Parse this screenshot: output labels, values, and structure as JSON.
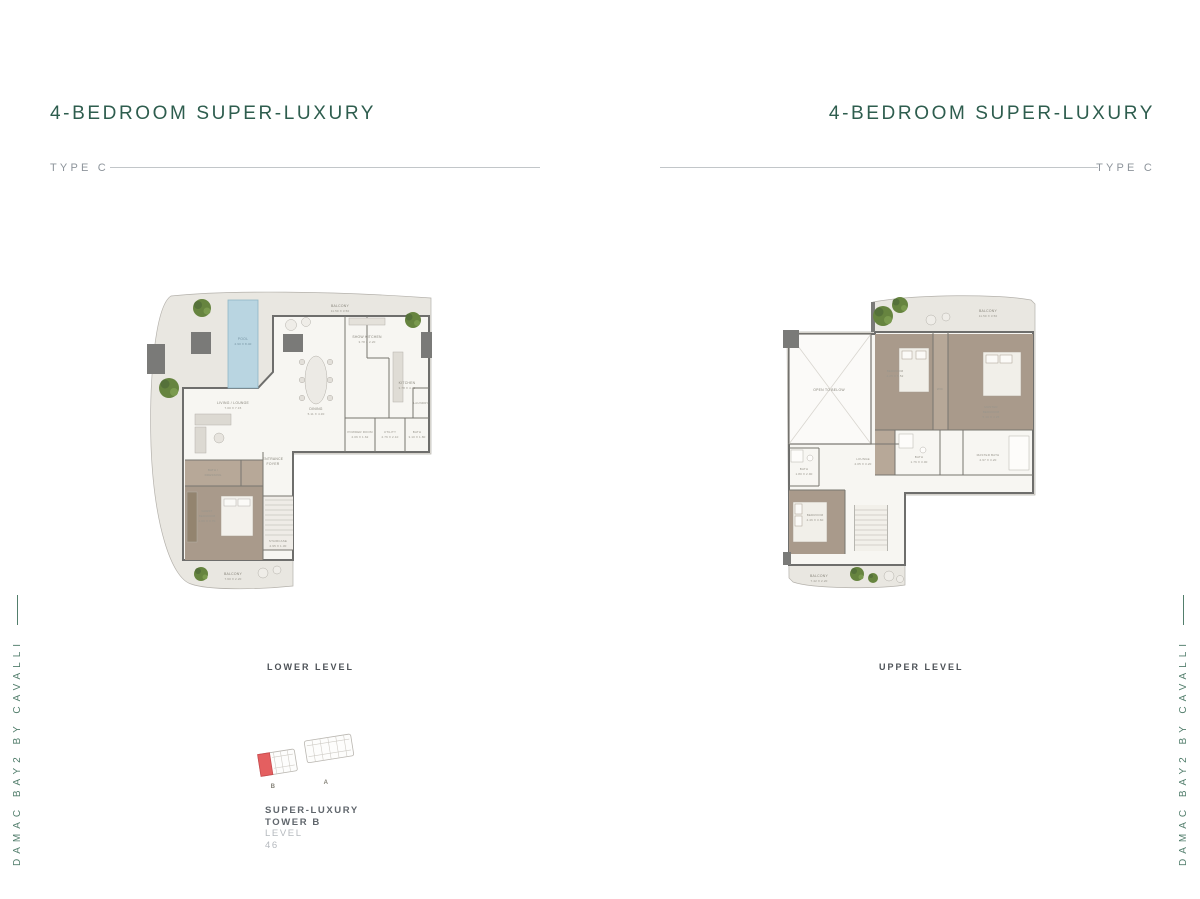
{
  "header_left": {
    "title": "4-BEDROOM SUPER-LUXURY",
    "type_label": "TYPE C"
  },
  "header_right": {
    "title": "4-BEDROOM SUPER-LUXURY",
    "type_label": "TYPE C"
  },
  "side_text": "DAMAC BAY2 BY CAVALLI",
  "captions": {
    "lower": "LOWER LEVEL",
    "upper": "UPPER LEVEL"
  },
  "keyplan": {
    "tower_b": "B",
    "tower_a": "A"
  },
  "footer": {
    "line1": "SUPER-LUXURY",
    "line2": "TOWER B",
    "level_label": "LEVEL",
    "level_value": "46"
  },
  "colors": {
    "accent_green": "#2e5d4e",
    "side_green": "#527e6c",
    "caption_gray": "#4d5257",
    "muted_gray": "#8d949b",
    "floor": "#e9e7e1",
    "indoor": "#f7f6f2",
    "wall": "#6e6e6c",
    "bedroom_taupe": "#a99a8b",
    "pool_blue": "#b9d5e1",
    "tree_green": "#66843f",
    "keyplan_red": "#e45f60"
  },
  "lower_plan": {
    "rooms": {
      "pool": {
        "name": "POOL",
        "dims": "2.90 X 8.40"
      },
      "balcony_top": {
        "name": "BALCONY",
        "dims": "11.50 X 3.50"
      },
      "show_kitchen": {
        "name": "SHOW KITCHEN",
        "dims": "3.78 X 2.20"
      },
      "kitchen": {
        "name": "KITCHEN",
        "dims": "3.78 X 4.35"
      },
      "dining": {
        "name": "DINING",
        "dims": "5.11 X 4.30"
      },
      "living": {
        "name": "LIVING / LOUNGE",
        "dims": "7.00 X 7.15"
      },
      "foyer": {
        "name": "ENTRANCE",
        "name2": "FOYER"
      },
      "powder": {
        "name": "POWDER ROOM",
        "dims": "2.06 X 1.62"
      },
      "utility": {
        "name": "UTILITY",
        "dims": "2.76 X 2.10"
      },
      "laundry": {
        "name": "LAUNDRY"
      },
      "bath": {
        "name": "BATH",
        "dims": "3.10 X 1.80"
      },
      "dressing": {
        "name": "BATH /",
        "name2": "DRESSING"
      },
      "guest_bedroom": {
        "name": "GUEST",
        "name2": "BEDROOM",
        "dims": "4.09 X 3.70"
      },
      "staircase": {
        "name": "STAIRCASE",
        "dims": "2.95 X 1.30"
      },
      "balcony_bottom": {
        "name": "BALCONY",
        "dims": "7.60 X 2.20"
      }
    }
  },
  "upper_plan": {
    "rooms": {
      "balcony_top": {
        "name": "BALCONY",
        "dims": "11.50 X 3.50"
      },
      "open_to_below": {
        "name": "OPEN TO BELOW"
      },
      "bedroom": {
        "name": "BEDROOM",
        "dims": "4.25 X 5.52"
      },
      "wic": {
        "name": "WIC"
      },
      "master_bedroom": {
        "name": "MASTER",
        "name2": "BEDROOM",
        "dims": "5.10 X 4.25"
      },
      "bath": {
        "name": "BATH",
        "dims": "1.76 X 3.00"
      },
      "lounge": {
        "name": "LOUNGE",
        "dims": "2.05 X 3.20"
      },
      "master_bath": {
        "name": "MASTER BATH",
        "dims": "2.97 X 3.20"
      },
      "bath2": {
        "name": "BATH",
        "dims": "1.80 X 2.90"
      },
      "bedroom2": {
        "name": "BEDROOM",
        "dims": "4.46 X 3.60"
      },
      "balcony_bottom": {
        "name": "BALCONY",
        "dims": "7.42 X 2.20"
      }
    }
  }
}
